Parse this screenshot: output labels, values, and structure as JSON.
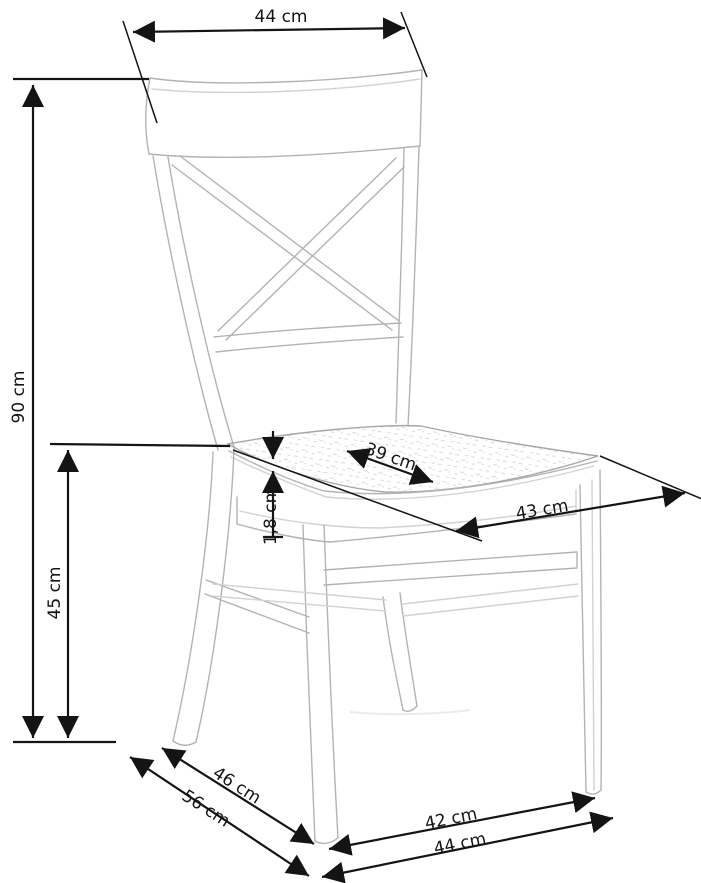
{
  "figure": {
    "type": "furniture dimension diagram",
    "subject": "cross-back wooden dining chair line drawing",
    "unit": "cm",
    "background_color": "#ffffff",
    "dimension_line_color": "#141414",
    "drawing_line_color": "#b3b3b3"
  },
  "dims": [
    {
      "id": "back-width",
      "label": "44 cm",
      "value_cm": 44,
      "orientation": "horizontal-top"
    },
    {
      "id": "total-height",
      "label": "90 cm",
      "value_cm": 90,
      "orientation": "vertical-left-outer"
    },
    {
      "id": "seat-height",
      "label": "45 cm",
      "value_cm": 45,
      "orientation": "vertical-left-inner"
    },
    {
      "id": "seat-thickness",
      "label": "1,8 cm",
      "value_cm": 1.8,
      "orientation": "vertical-at-seat"
    },
    {
      "id": "seat-depth",
      "label": "39 cm",
      "value_cm": 39,
      "orientation": "diagonal-on-seat"
    },
    {
      "id": "seat-width",
      "label": "43 cm",
      "value_cm": 43,
      "orientation": "diagonal-below-seat"
    },
    {
      "id": "side-depth",
      "label": "46 cm",
      "value_cm": 46,
      "orientation": "diagonal-bottom-left-upper"
    },
    {
      "id": "total-depth",
      "label": "56 cm",
      "value_cm": 56,
      "orientation": "diagonal-bottom-left-lower"
    },
    {
      "id": "front-feet-width",
      "label": "42 cm",
      "value_cm": 42,
      "orientation": "horizontal-bottom-upper"
    },
    {
      "id": "total-width",
      "label": "44 cm",
      "value_cm": 44,
      "orientation": "horizontal-bottom-lower"
    }
  ]
}
